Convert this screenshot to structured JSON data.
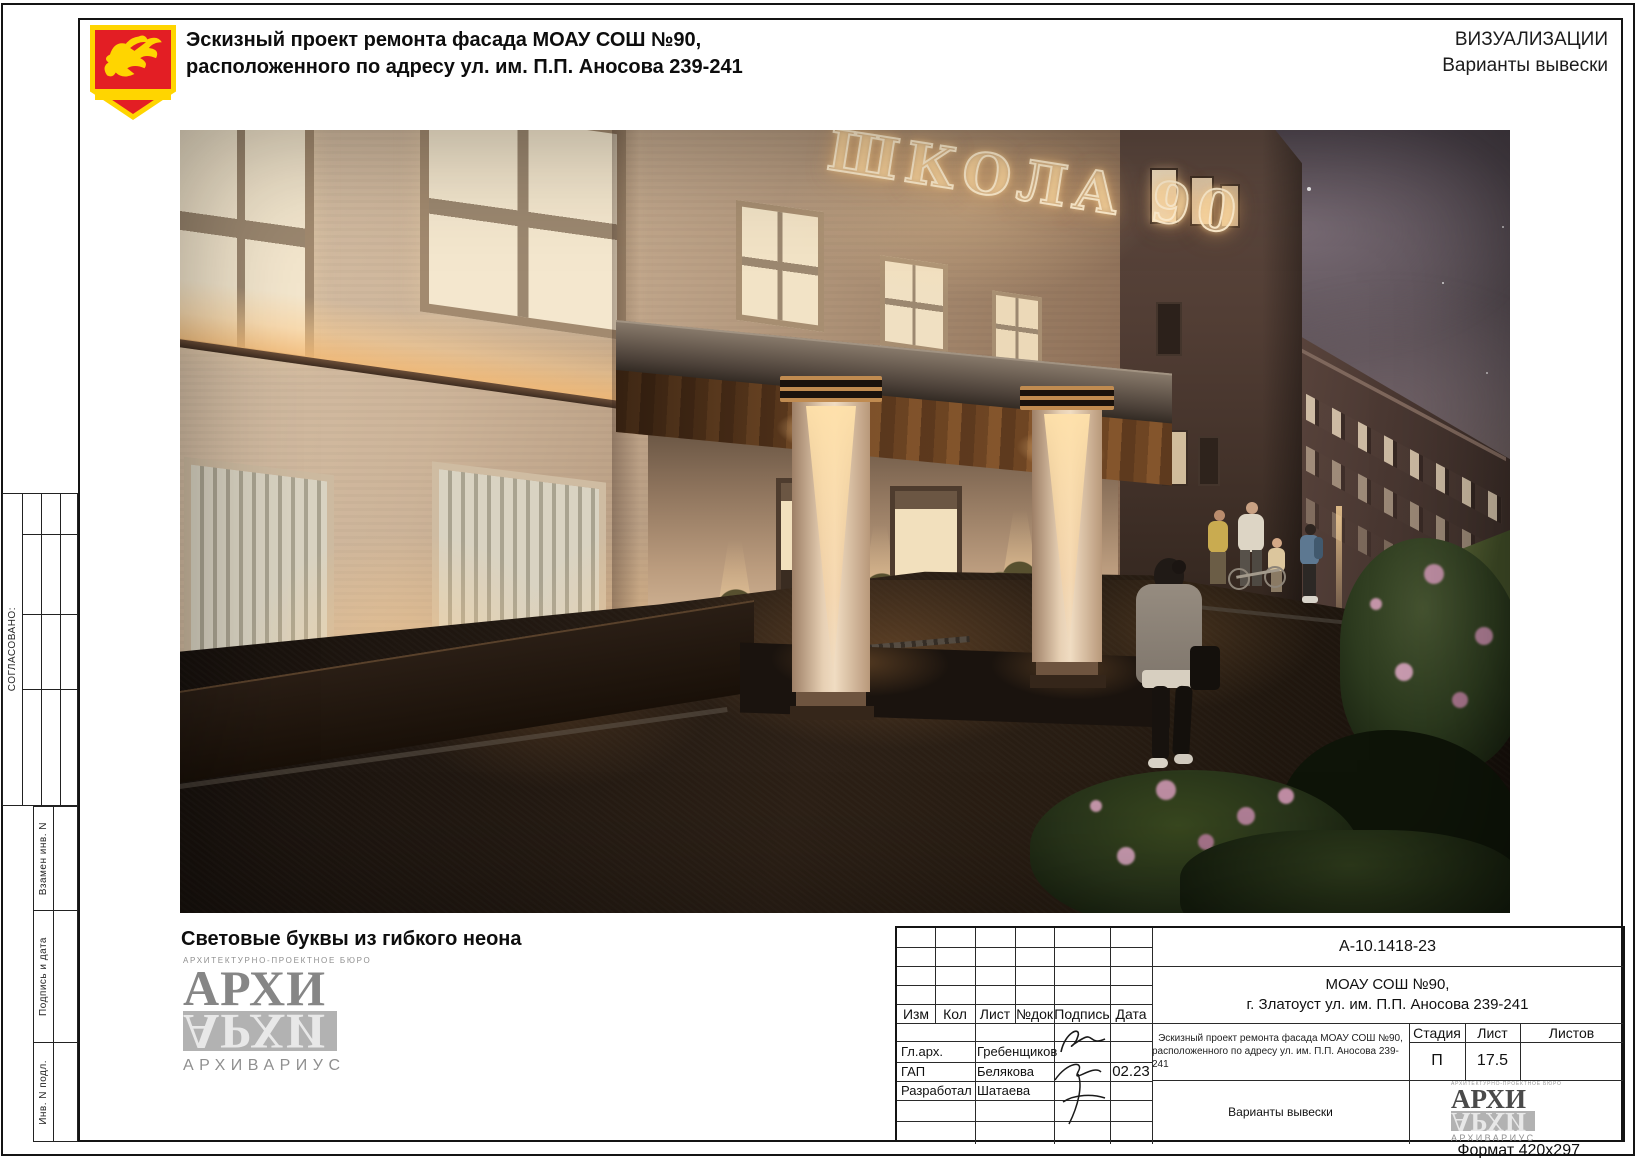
{
  "header": {
    "title_line1": "Эскизный проект ремонта фасада МОАУ СОШ №90,",
    "title_line2": "расположенного по адресу ул. им. П.П. Аносова 239-241",
    "right_line1": "ВИЗУАЛИЗАЦИИ",
    "right_line2": "Варианты вывески"
  },
  "left_margin": {
    "agreed": "СОГЛАСОВАНО:",
    "row_labels": [
      "Взамен инв. N",
      "Подпись и дата",
      "Инв. N подл."
    ]
  },
  "render": {
    "sign_text": "ШКОЛА 90",
    "caption": "Световые буквы из гибкого неона"
  },
  "logo": {
    "bureau": "АРХИТЕКТУРНО-ПРОЕКТНОЕ БЮРО",
    "name": "АРХИ",
    "brand": "АРХИВАРИУС"
  },
  "stamp": {
    "doc_number": "А-10.1418-23",
    "object_line1": "МОАУ СОШ №90,",
    "object_line2": "г. Златоуст ул. им. П.П. Аносова 239-241",
    "col_izm": "Изм",
    "col_kol": "Кол",
    "col_list": "Лист",
    "col_doc": "№док",
    "col_sign": "Подпись",
    "col_date": "Дата",
    "role1": "Гл.арх.",
    "name1": "Гребенщиков",
    "role2": "ГАП",
    "name2": "Белякова",
    "date2": "02.23",
    "role3": "Разработал",
    "name3": "Шатаева",
    "project_line1": "Эскизный проект ремонта фасада МОАУ СОШ №90,",
    "project_line2": "расположенного по адресу ул. им. П.П. Аносова 239-241",
    "stage_label": "Стадия",
    "sheet_label": "Лист",
    "sheets_label": "Листов",
    "stage_value": "П",
    "sheet_value": "17.5",
    "sheets_value": "",
    "content_title": "Варианты вывески"
  },
  "footer": {
    "format_note": "Формат 420х297"
  },
  "colors": {
    "emblem_red": "#e31e24",
    "emblem_yellow": "#ffd500",
    "neon_glow": "#ffeed0"
  }
}
